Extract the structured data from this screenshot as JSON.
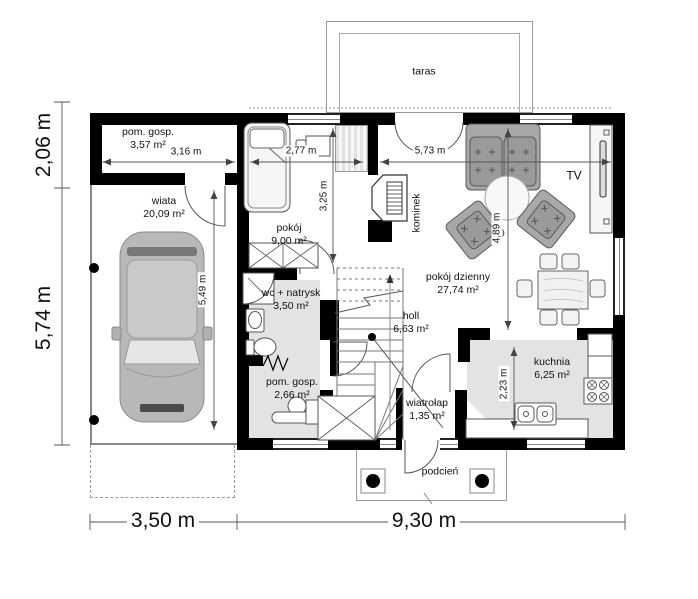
{
  "plan": {
    "rooms": {
      "taras": {
        "name": "taras"
      },
      "pom_gosp_1": {
        "name": "pom. gosp.",
        "area": "3,57 m²"
      },
      "wiata": {
        "name": "wiata",
        "area": "20,09 m²"
      },
      "pokoj": {
        "name": "pokój",
        "area": "9,00 m²"
      },
      "kominek": {
        "name": "kominek"
      },
      "pokoj_dzienny": {
        "name": "pokój dzienny",
        "area": "27,74 m²"
      },
      "wc_natrysk": {
        "name": "wc + natrysk",
        "area": "3,50 m²"
      },
      "holl": {
        "name": "holl",
        "area": "6,63 m²"
      },
      "pom_gosp_2": {
        "name": "pom. gosp.",
        "area": "2,66 m²"
      },
      "wiatrolap": {
        "name": "wiatrołap",
        "area": "1,35 m²"
      },
      "kuchnia": {
        "name": "kuchnia",
        "area": "6,25 m²"
      },
      "podcien": {
        "name": "podcień"
      }
    },
    "labels": {
      "tv": "TV"
    },
    "dimensions": {
      "outer_left_top": "2,06 m",
      "outer_left_bottom": "5,74 m",
      "outer_bottom_left": "3,50 m",
      "outer_bottom_right": "9,30 m",
      "pom_gosp_width": "3,16 m",
      "pokoj_width": "2,77 m",
      "salon_width": "5,73 m",
      "pokoj_depth": "3,25 m",
      "wiata_depth": "5,49 m",
      "salon_depth": "4,89 m",
      "kuchnia_depth": "2,23 m"
    },
    "colors": {
      "wall": "#000000",
      "wet_room_floor": "#e3e3e3",
      "upholstery": "#a0a0a0",
      "car_body": "#b8b8b8",
      "linework": "#555555"
    }
  }
}
